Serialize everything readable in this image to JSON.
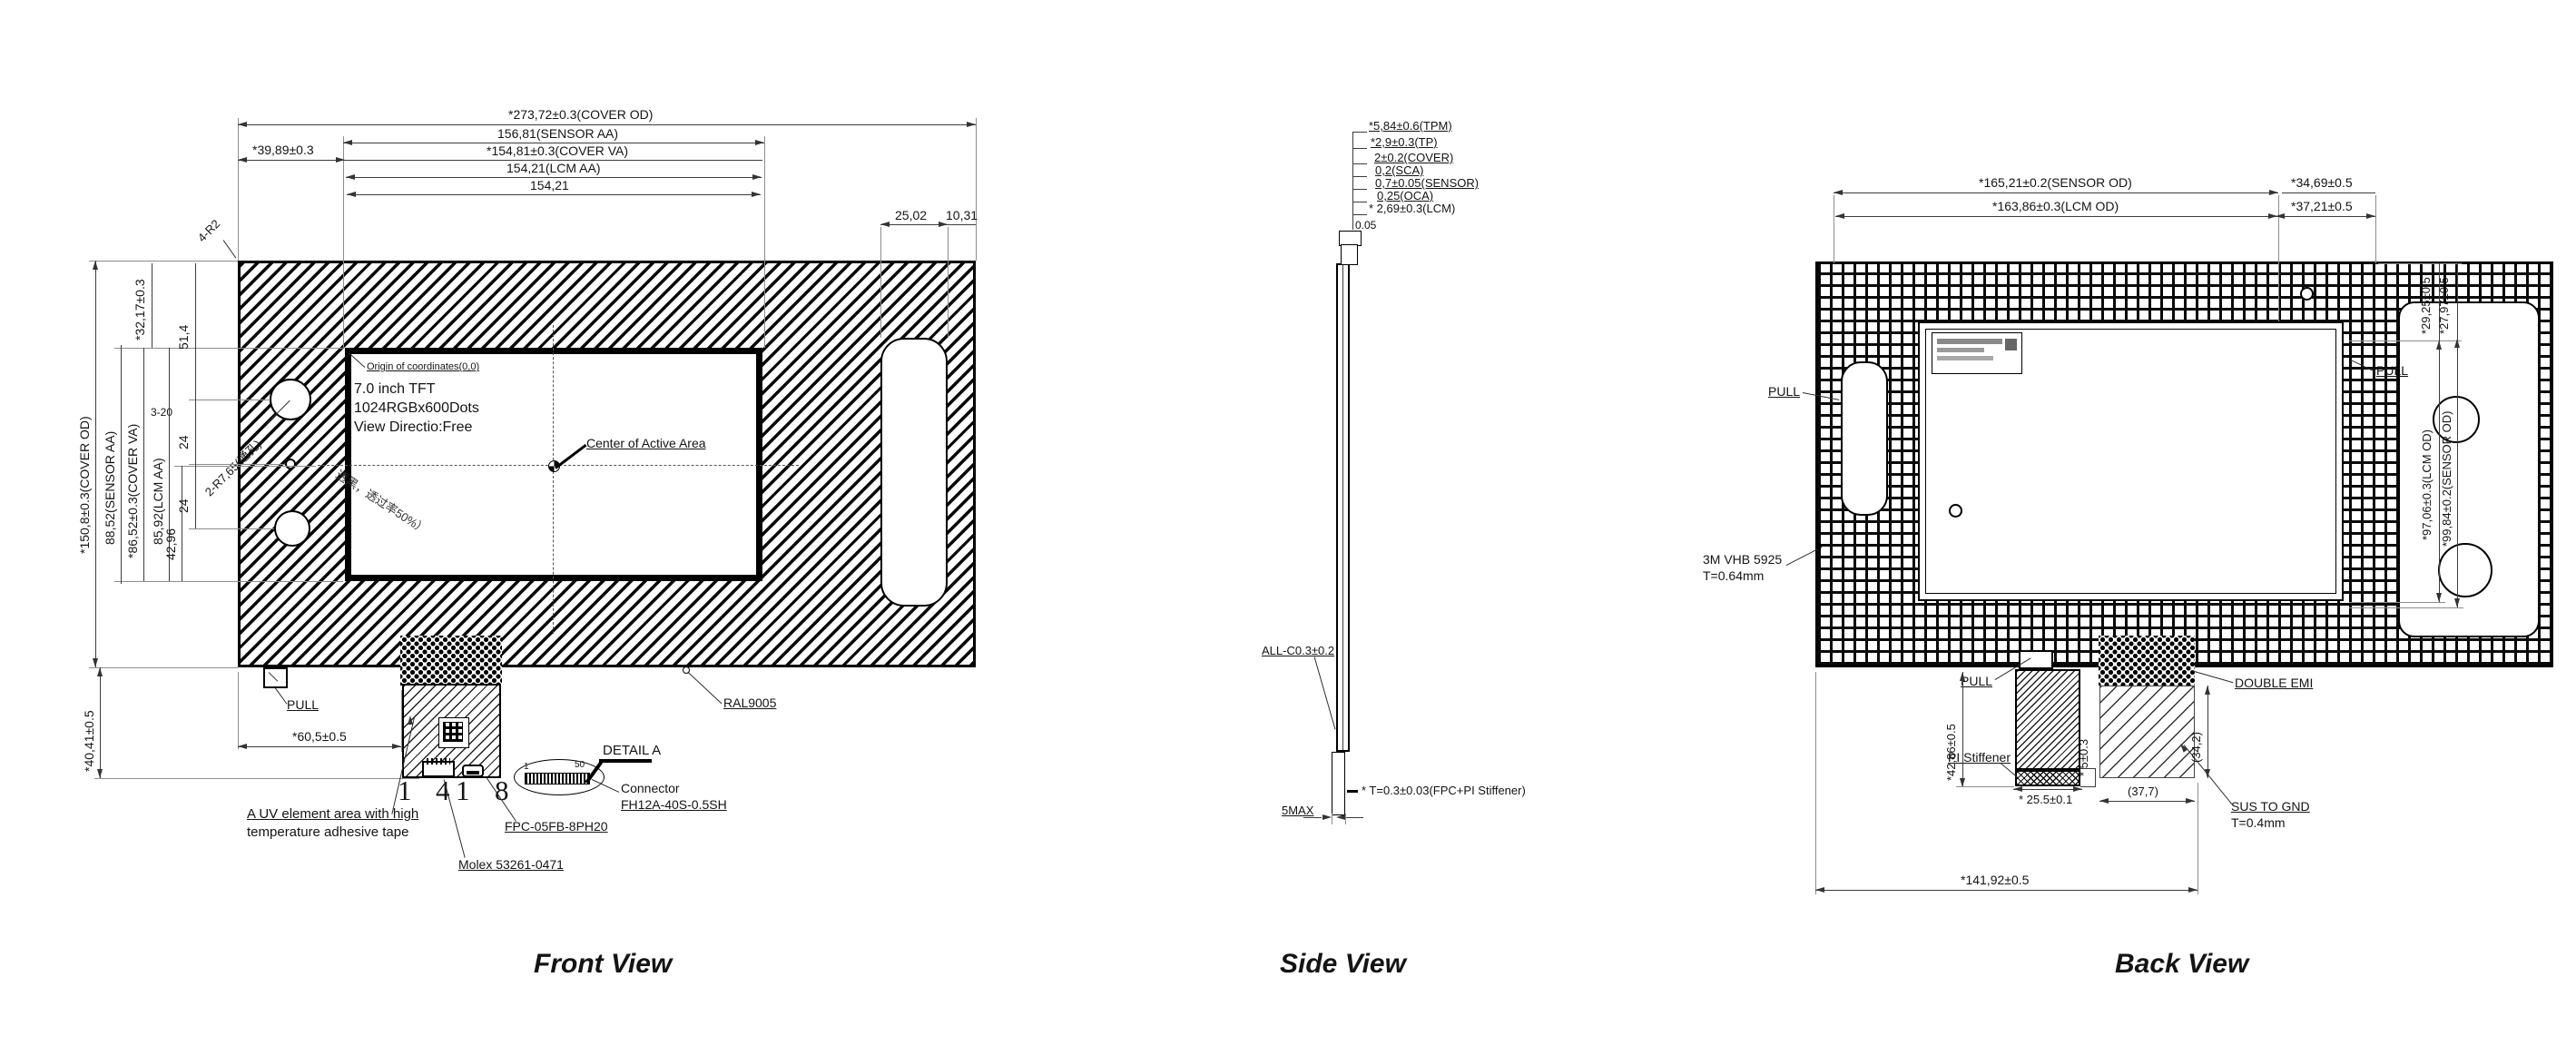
{
  "drawing": {
    "front": {
      "title": "Front View",
      "top_dims": {
        "cover_od": "*273,72±0.3(COVER OD)",
        "sensor_aa": "156,81(SENSOR AA)",
        "cover_va": "*154,81±0.3(COVER VA)",
        "lcm_aa": "154,21(LCM AA)",
        "aa": "154,21",
        "offset_left": "*39,89±0.3",
        "slot_w": "25,02",
        "slot_edge": "10,31"
      },
      "left_dims": {
        "cover_od": "*150,8±0.3(COVER OD)",
        "sensor_aa": "88,52(SENSOR AA)",
        "cover_va": "*86,52±0.3(COVER VA)",
        "lcm_aa": "85,92(LCM AA)",
        "half_aa": "42,96",
        "top_offset": "*32,17±0.3",
        "hole_top": "51,4",
        "hole_pitch1": "24",
        "hole_pitch2": "24",
        "holes_small": "3-20",
        "tail": "*40,41±0.5"
      },
      "notes": {
        "corner": "4-R2",
        "holes": "2-R7,65(通孔)",
        "origin": "Origin of coordinates(0,0)",
        "spec_l1": "7.0 inch TFT",
        "spec_l2": "1024RGBx600Dots",
        "spec_l3": "View Directio:Free",
        "center": "Center of Active Area",
        "silk": "透黑，透过率50%）",
        "pull": "PULL",
        "fpc_offset": "*60,5±0.5",
        "uv_l1": "A UV element area with high",
        "uv_l2": "temperature adhesive tape",
        "paint": "RAL9005",
        "detail": "DETAIL A",
        "conn_l1": "Connector",
        "conn_l2": "FH12A-40S-0.5SH",
        "fpc_part": "FPC-05FB-8PH20",
        "molex": "Molex 53261-0471",
        "pin_1a": "1",
        "pin_4": "4",
        "pin_1b": "1",
        "pin_8": "8",
        "pin_first": "1",
        "pin_last": "50"
      }
    },
    "side": {
      "title": "Side View",
      "stack": [
        "*5,84±0.6(TPM)",
        "*2,9±0.3(TP)",
        "2±0.2(COVER)",
        "0,2(SCA)",
        "0,7±0.05(SENSOR)",
        "0,25(OCA)",
        "* 2,69±0.3(LCM)"
      ],
      "gap": "0.05",
      "chamfer": "ALL-C0.3±0.2",
      "fpc_t": "* T=0.3±0.03(FPC+PI Stiffener)",
      "fpc_len": "5MAX"
    },
    "back": {
      "title": "Back View",
      "top_dims": {
        "sensor_od": "*165,21±0.2(SENSOR OD)",
        "lcm_od": "*163,86±0.3(LCM OD)",
        "wing_a": "*34,69±0.5",
        "wing_b": "*37,21±0.5"
      },
      "right_dims": {
        "a": "*29,25±0.5",
        "b": "*27,97±0.5",
        "lcm_od_v": "*97,06±0.3(LCM OD)",
        "sensor_od_v": "*99,84±0.2(SENSOR OD)"
      },
      "notes": {
        "pull_left": "PULL",
        "pull_right": "PULL",
        "pull_bottom": "PULL",
        "vhb_l1": "3M VHB 5925",
        "vhb_l2": "T=0.64mm",
        "pi": "PI Stiffener",
        "emi": "DOUBLE EMI",
        "sus_l1": "SUS TO GND",
        "sus_l2": "T=0.4mm"
      },
      "bottom_dims": {
        "fpc_h": "*42,86±0.5",
        "total": "*141,92±0.5",
        "fpc_w": "* 25.5±0.1",
        "pi_t": "* 5±0.3",
        "sus_w": "(37,7)",
        "sus_h": "(34,2)"
      }
    }
  }
}
